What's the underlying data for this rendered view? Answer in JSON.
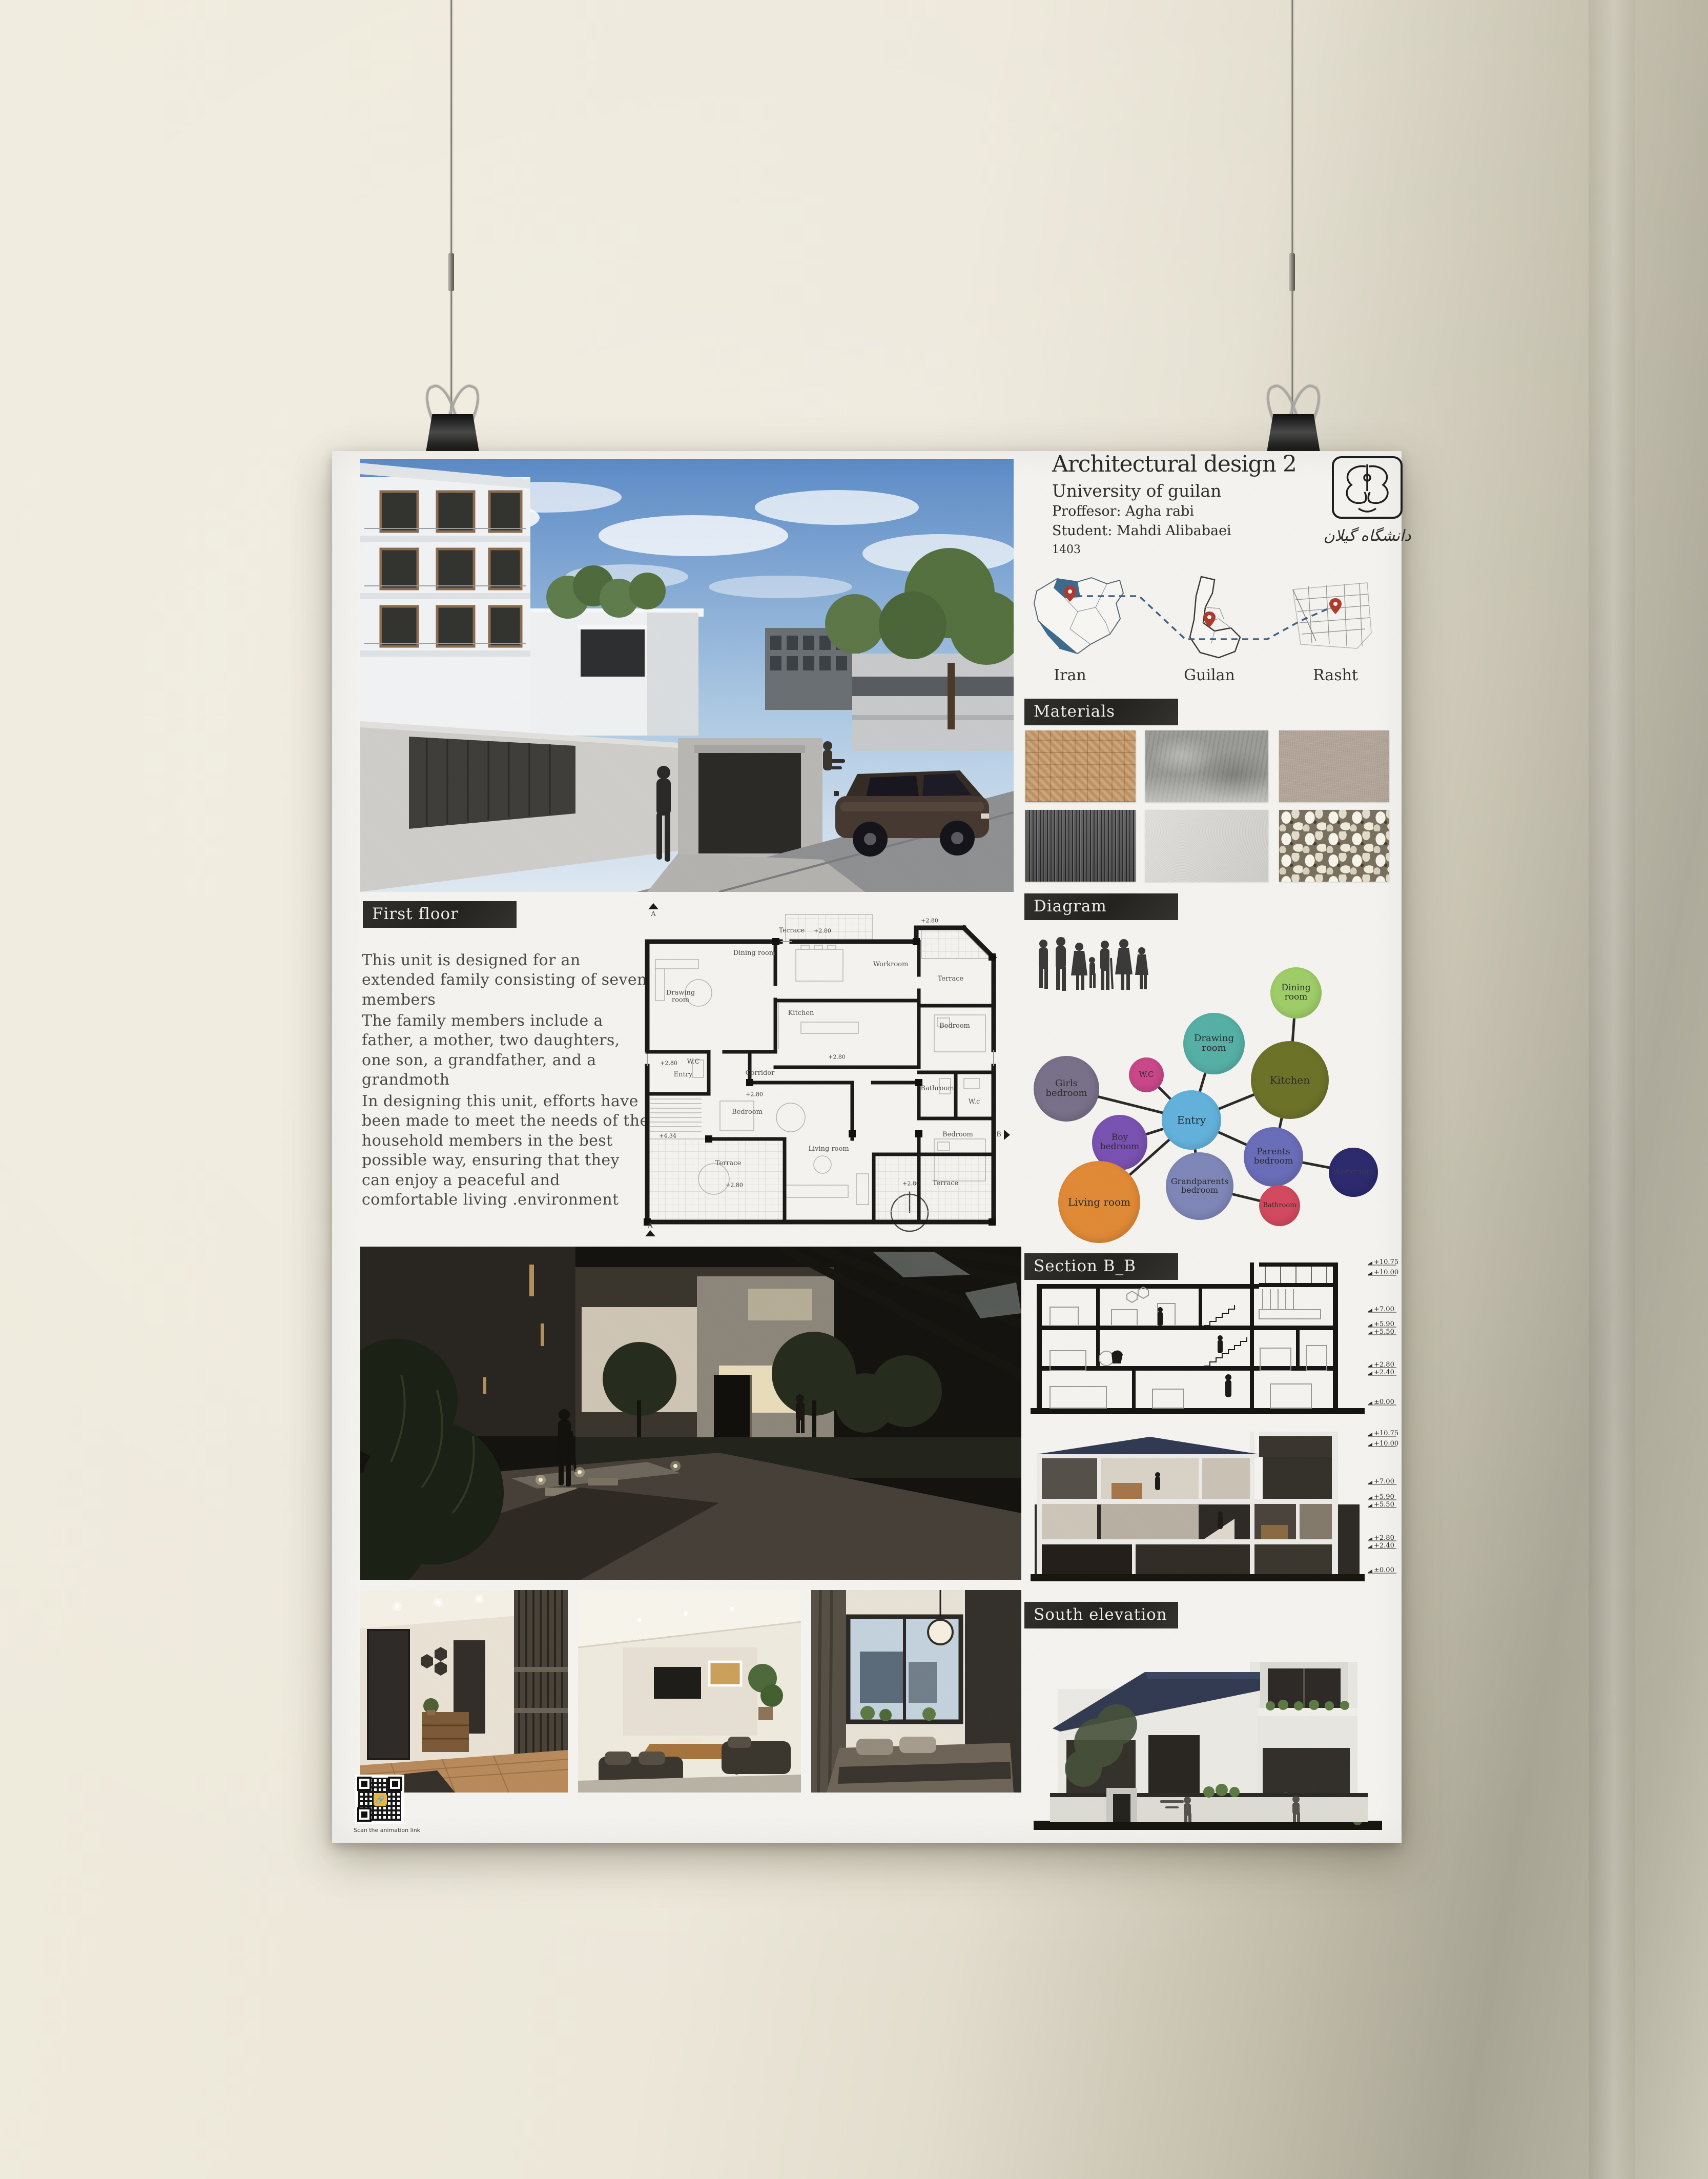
{
  "scene": {
    "wall_color": "#e9e4d6",
    "poster_color": "#f4f3ef"
  },
  "poster": {
    "title_block": {
      "title": "Architectural design 2",
      "university": "University of guilan",
      "professor": "Proffesor: Agha rabi",
      "student": "Student: Mahdi Alibabaei",
      "year": "1403",
      "logo_text": "دانشگاه گیلان"
    },
    "maps": {
      "labels": [
        "Iran",
        "Guilan",
        "Rasht"
      ],
      "pin_color": "#b03a2e",
      "sea_color": "#3d6b8e"
    },
    "headers": {
      "first_floor": "First floor",
      "materials": "Materials",
      "diagram": "Diagram",
      "section_bb": "Section B_B",
      "south_elevation": "South elevation"
    },
    "first_floor": {
      "p1": "This unit is designed for an extended family consisting of seven members",
      "p2": "The family members include a father, a mother, two daughters, one son, a grandfather, and a grandmoth",
      "p3": "In designing this unit, efforts have been made to meet the needs of the household members in the best possible way, ensuring that they can enjoy a peaceful and comfortable living .environment"
    },
    "materials": {
      "items": [
        {
          "name": "wood-parquet",
          "color": "#c79b6b"
        },
        {
          "name": "rough-concrete",
          "color": "#9c9c98"
        },
        {
          "name": "stucco-plaster",
          "color": "#b4a69a"
        },
        {
          "name": "dark-wood-slats",
          "color": "#5c5c5c"
        },
        {
          "name": "light-plaster",
          "color": "#d9d8d4"
        },
        {
          "name": "white-pebbles",
          "color": "#e9e5d8"
        }
      ]
    },
    "diagram": {
      "bubbles": [
        {
          "label": "Dining room",
          "color": "#9fcd68"
        },
        {
          "label": "Drawing room",
          "color": "#55b0a6"
        },
        {
          "label": "W.C",
          "color": "#c94889"
        },
        {
          "label": "Kitchen",
          "color": "#6d7229"
        },
        {
          "label": "Girls bedroom",
          "color": "#79708a"
        },
        {
          "label": "Entry",
          "color": "#63b2dc"
        },
        {
          "label": "Boy bedroom",
          "color": "#7a52b2"
        },
        {
          "label": "Parents bedroom",
          "color": "#6a6db8"
        },
        {
          "label": "Workroom",
          "color": "#2d2a6e"
        },
        {
          "label": "Grandparents bedroom",
          "color": "#7f87b8"
        },
        {
          "label": "Bathroom",
          "color": "#d34a5f"
        },
        {
          "label": "Living room",
          "color": "#e08a37"
        }
      ]
    },
    "floor_plan": {
      "rooms": [
        "Terrace",
        "Dining room",
        "Workroom",
        "Terrace",
        "Drawing room",
        "Kitchen",
        "Bedroom",
        "W.C",
        "Corridor",
        "Entry",
        "Bathroom",
        "W.c",
        "Bedroom",
        "Bedroom",
        "Living room",
        "Terrace",
        "Terrace"
      ],
      "levels": [
        "+2.80",
        "+4.34"
      ],
      "sections": [
        "A",
        "B"
      ]
    },
    "section_levels": [
      "+10.75",
      "+10.00",
      "+7.00",
      "+5.90",
      "+5.50",
      "+2.80",
      "+2.40",
      "±0.00"
    ],
    "qr_caption": "Scan the animation link"
  }
}
